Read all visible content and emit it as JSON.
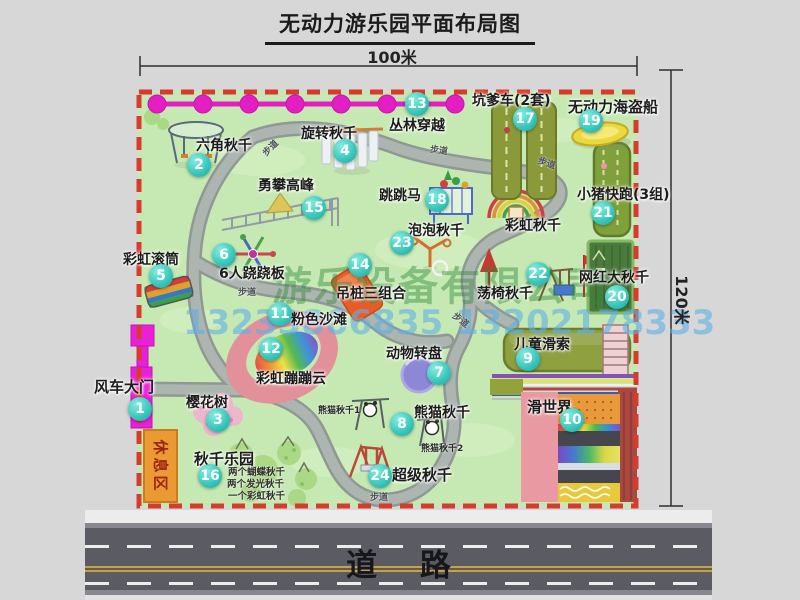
{
  "title": "无动力游乐园平面布局图",
  "dimensions": {
    "top": "100米",
    "right": "120米"
  },
  "road": {
    "label": "道 路"
  },
  "watermark": {
    "company": "游乐设备有限公司",
    "phone": "13233806835 13202178333"
  },
  "rest_area": "休息区",
  "path_label": "步道",
  "extra_labels": {
    "rainbow_swing": "彩虹秋千",
    "panda_swing_1": "熊猫秋千1",
    "panda_swing_2": "熊猫秋千2"
  },
  "attractions": [
    {
      "num": "1",
      "label": "风车大门"
    },
    {
      "num": "2",
      "label": "六角秋千"
    },
    {
      "num": "3",
      "label": "樱花树"
    },
    {
      "num": "4",
      "label": "旋转秋千"
    },
    {
      "num": "5",
      "label": "彩虹滚筒"
    },
    {
      "num": "6",
      "label": "6人跷跷板"
    },
    {
      "num": "7",
      "label": "动物转盘"
    },
    {
      "num": "8",
      "label": "熊猫秋千"
    },
    {
      "num": "9",
      "label": "儿童滑索"
    },
    {
      "num": "10",
      "label": "滑世界"
    },
    {
      "num": "11",
      "label": "粉色沙滩"
    },
    {
      "num": "12",
      "label": "彩虹蹦蹦云"
    },
    {
      "num": "13",
      "label": "丛林穿越"
    },
    {
      "num": "14",
      "label": "吊桩三组合"
    },
    {
      "num": "15",
      "label": "勇攀高峰"
    },
    {
      "num": "16",
      "label": "秋千乐园",
      "notes": [
        "两个蝴蝶秋千",
        "两个发光秋千",
        "一个彩虹秋千"
      ]
    },
    {
      "num": "17",
      "label": "坑爹车(2套)"
    },
    {
      "num": "18",
      "label": "跳跳马"
    },
    {
      "num": "19",
      "label": "无动力海盗船"
    },
    {
      "num": "20",
      "label": "网红大秋千"
    },
    {
      "num": "21",
      "label": "小猪快跑(3组)"
    },
    {
      "num": "22",
      "label": "荡椅秋千"
    },
    {
      "num": "23",
      "label": "泡泡秋千"
    },
    {
      "num": "24",
      "label": "超级秋千"
    }
  ],
  "colors": {
    "park_green": "#c6e9b3",
    "boundary_red": "#d63c2c",
    "badge_teal": "#2fc4b8",
    "chain_magenta": "#e31fc3",
    "road_gray": "#5a5b63",
    "gate_magenta": "#ea1fd8",
    "rest_area_orange": "#eb9a33"
  }
}
